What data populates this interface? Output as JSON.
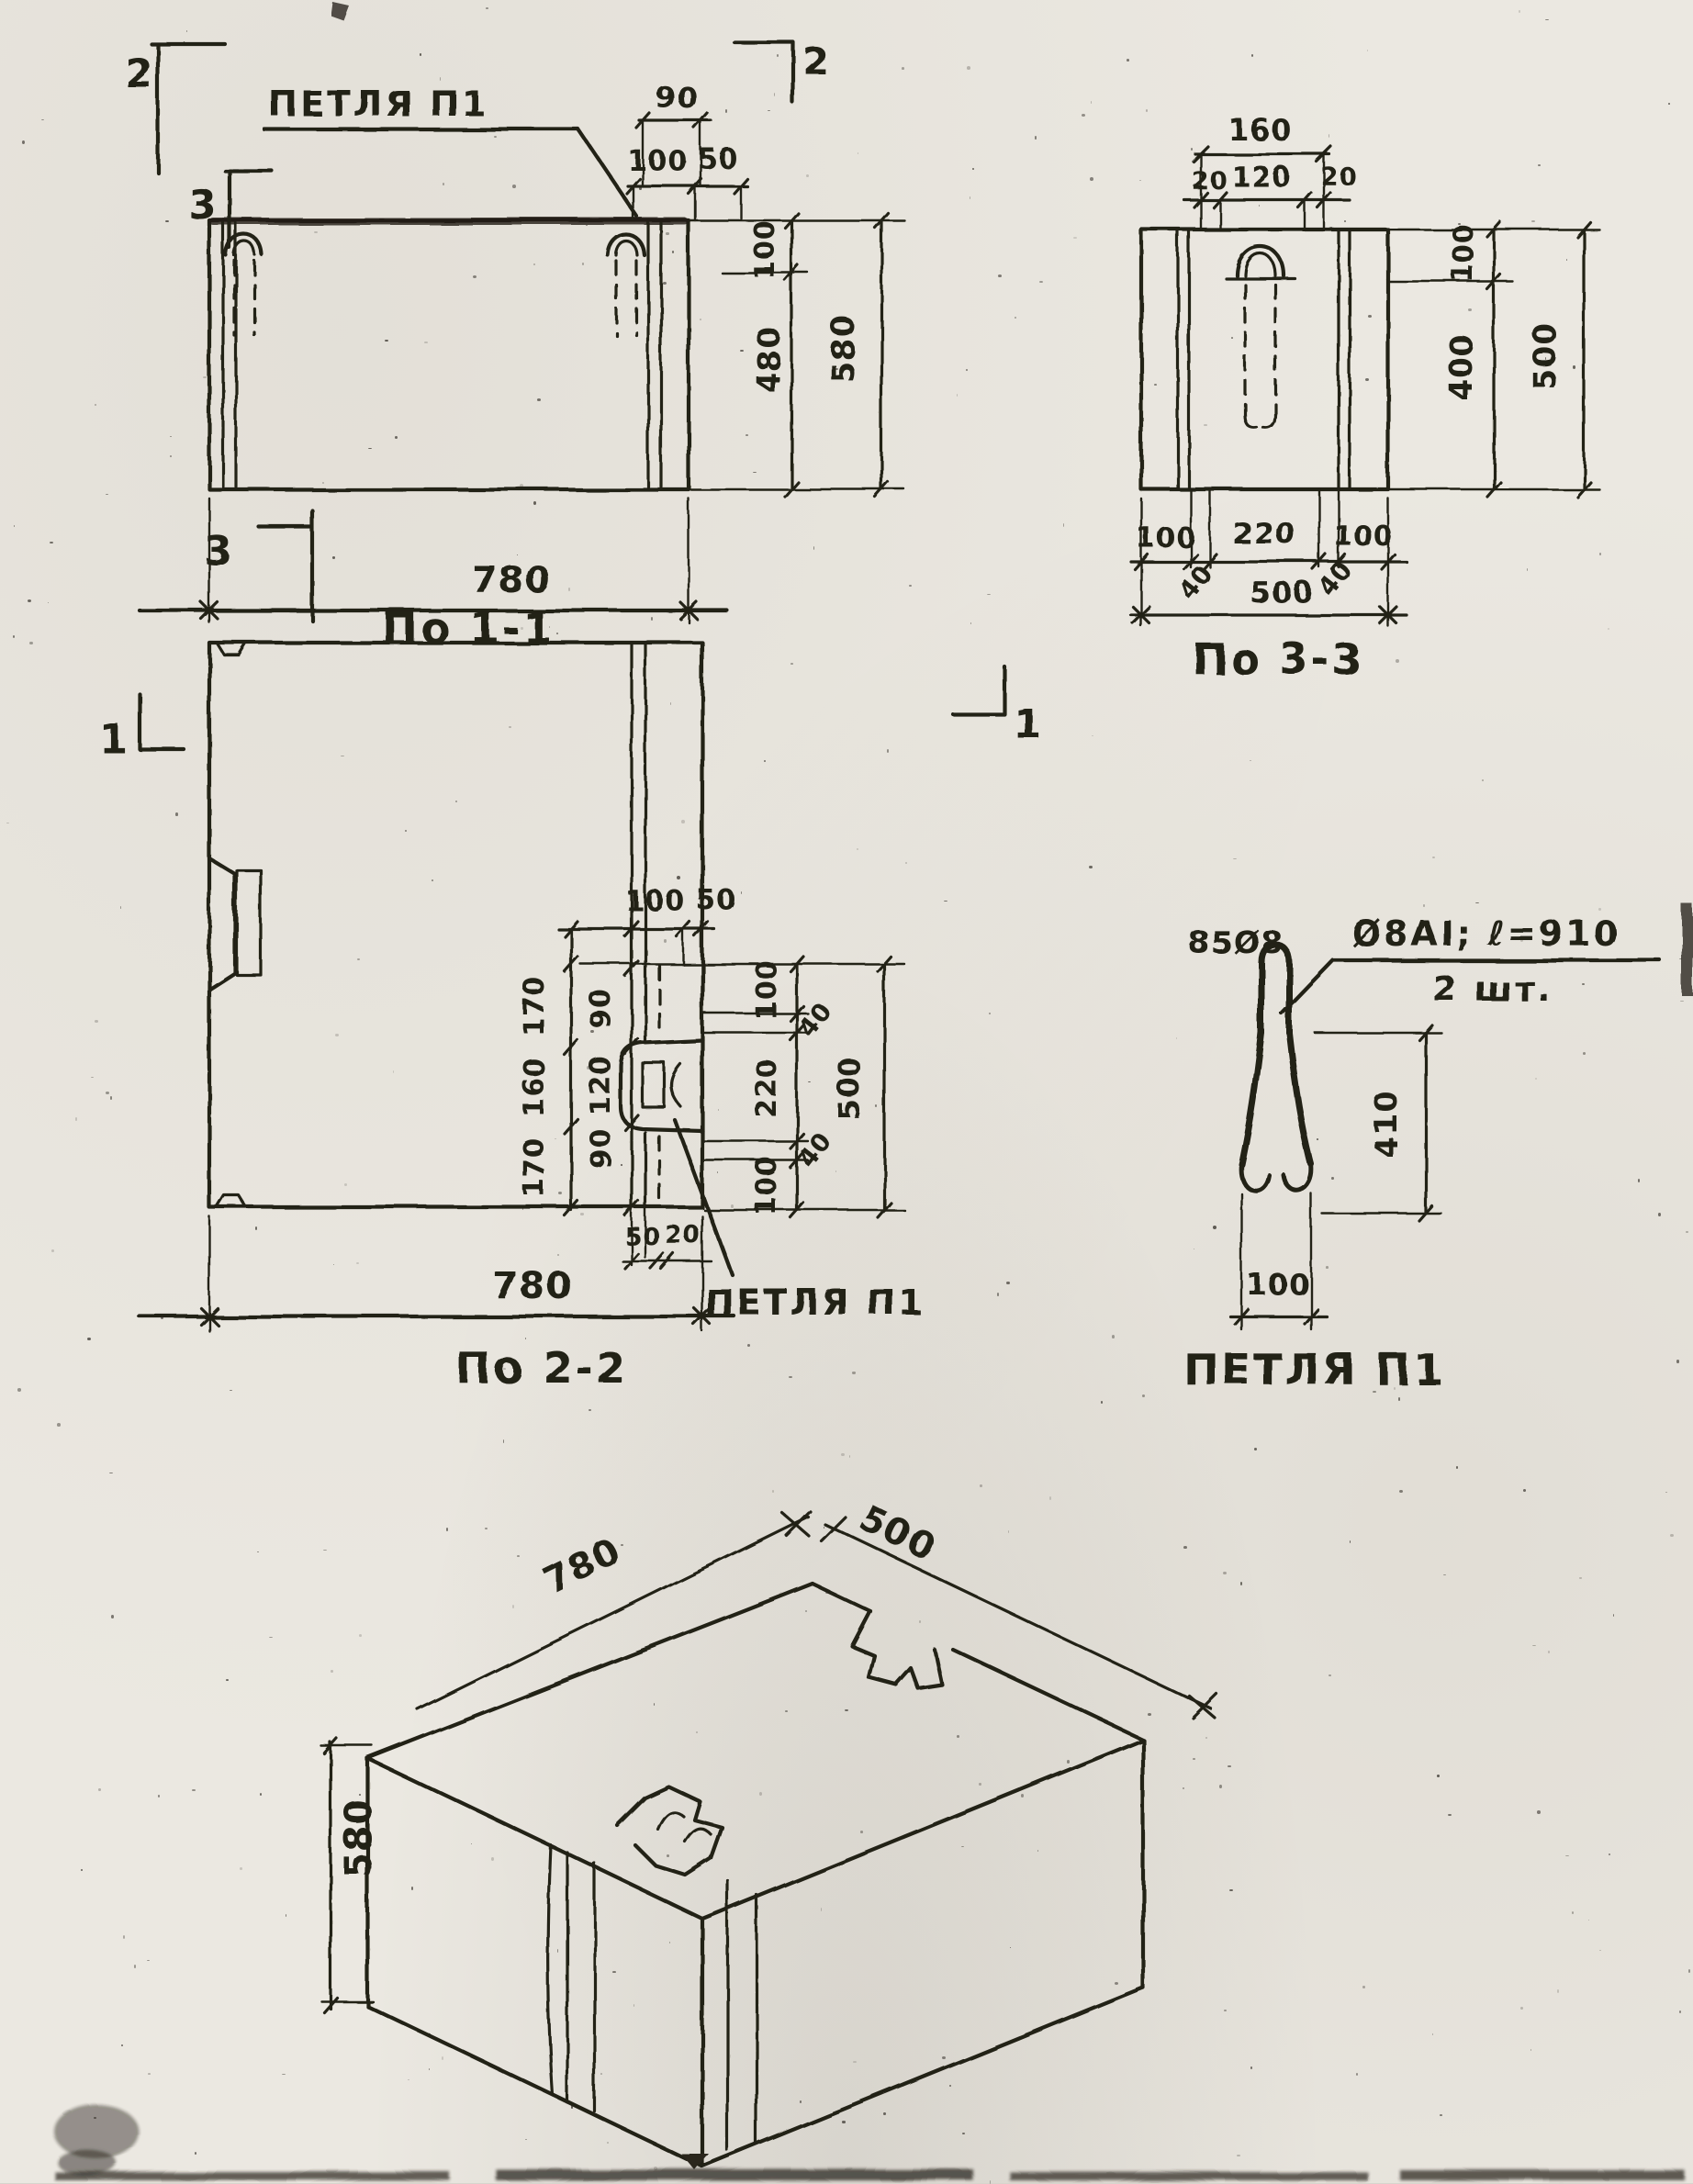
{
  "views": {
    "v11": {
      "caption": "По 1-1",
      "loop_label": "ПЕТЛЯ П1",
      "top_chain": {
        "upper": "90",
        "lower": [
          "100",
          "50"
        ]
      },
      "right_chain": [
        "100",
        "480",
        "580"
      ],
      "bottom": "780",
      "markers": {
        "top_left": "2",
        "top_right": "2",
        "left_top": "3",
        "left_bottom": "3"
      }
    },
    "v33": {
      "caption": "По 3-3",
      "top_total": "160",
      "top_chain": [
        "20",
        "120",
        "20"
      ],
      "right_chain": [
        "100",
        "400"
      ],
      "right_total": "500",
      "bottom_chain": [
        "100",
        "220",
        "100"
      ],
      "bottom_diag": [
        "40",
        "40"
      ],
      "bottom_total": "500"
    },
    "v22": {
      "caption": "По 2-2",
      "loop_label": "ПЕТЛЯ П1",
      "markers": {
        "left": "1",
        "right": "1"
      },
      "top_chain": [
        "100",
        "50"
      ],
      "left_outer_chain": [
        "170",
        "160",
        "170"
      ],
      "left_inner_chain": [
        "90",
        "120",
        "90"
      ],
      "right_chain": [
        "100",
        "220",
        "100"
      ],
      "right_diag": [
        "40",
        "40"
      ],
      "right_total": "500",
      "pocket_chain": [
        "50",
        "20"
      ],
      "bottom": "780"
    },
    "loop_detail": {
      "caption": "ПЕТЛЯ П1",
      "bend_label": "85Ø8",
      "spec": "Ø8АI; ℓ=910",
      "quantity": "2 шт.",
      "height": "410",
      "width": "100"
    },
    "iso": {
      "length": "780",
      "depth": "500",
      "height": "580"
    }
  },
  "ink_color": "#242018",
  "paper_color": "#ebe8e1"
}
